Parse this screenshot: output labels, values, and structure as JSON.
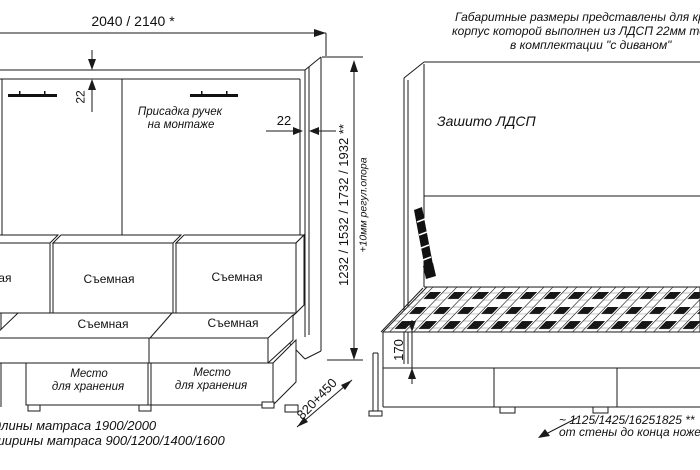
{
  "note_top_right": {
    "line1": "Габаритные размеры представлены для кров",
    "line2": "корпус которой выполнен из ЛДСП 22мм толщи",
    "line3": "в комплектации \"с диваном\""
  },
  "left_drawing": {
    "dim_width": "2040 / 2140 *",
    "dim_top_thickness": "22",
    "dim_side_thickness": "22",
    "handles_note_line1": "Присадка ручек",
    "handles_note_line2": "на монтаже",
    "back_cushion_left": "Съемная",
    "back_cushion_middle": "Съемная",
    "back_cushion_right": "Съемная",
    "seat_cushion_left": "Съемная",
    "seat_cushion_right": "Съемная",
    "drawer_left_line1": "Место",
    "drawer_left_line2": "для хранения",
    "drawer_right_line1": "Место",
    "drawer_right_line2": "для хранения",
    "dim_height": "1232 / 1532 / 1732 / 1932 **",
    "dim_height_note": "+10мм регул.опора",
    "dim_depth": "820+450"
  },
  "right_drawing": {
    "panel_label": "Зашито ЛДСП",
    "dim_base_height": "170",
    "floor_note_line1": "~ 1125/1425/16251825 **",
    "floor_note_line2": "от стены до конца ножек"
  },
  "footnotes": {
    "line1": "длины матраса 1900/2000",
    "line2": "ширины матраса 900/1200/1400/1600"
  },
  "colors": {
    "line": "#1a1a1a",
    "background": "#ffffff"
  }
}
